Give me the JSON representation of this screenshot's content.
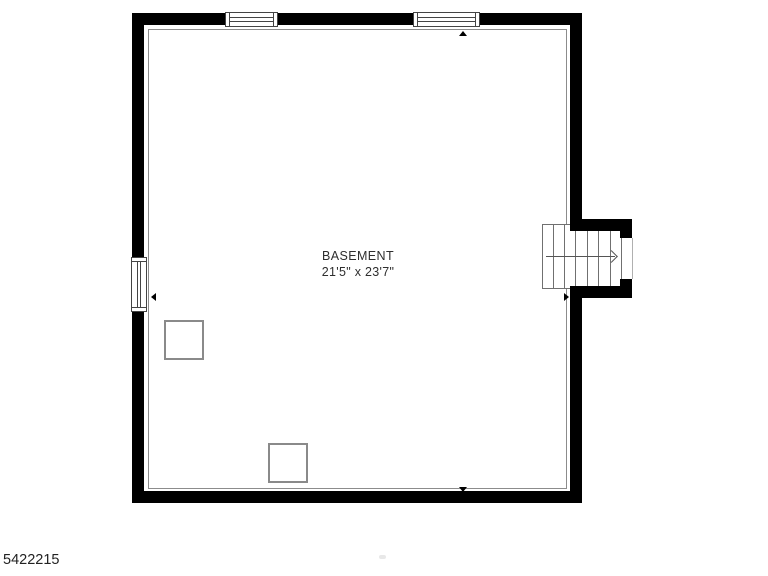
{
  "floor_plan": {
    "room": {
      "label": "BASEMENT",
      "dimensions": "21'5\" x 23'7\""
    },
    "listing_id": "5422215",
    "stairs": {
      "direction_arrow": "right",
      "treads": 7
    },
    "symbols": {
      "top_windows": 2,
      "left_windows": 1,
      "support_posts": 2,
      "wall_markers": [
        "up",
        "down",
        "left",
        "right"
      ]
    },
    "colors": {
      "wall": "#000000",
      "interior_outline": "#8c8c8c",
      "stair_outline": "#707070",
      "window_outline": "#444444",
      "post_outline": "#8a8a8a",
      "label_text": "#2e2e2e"
    }
  }
}
